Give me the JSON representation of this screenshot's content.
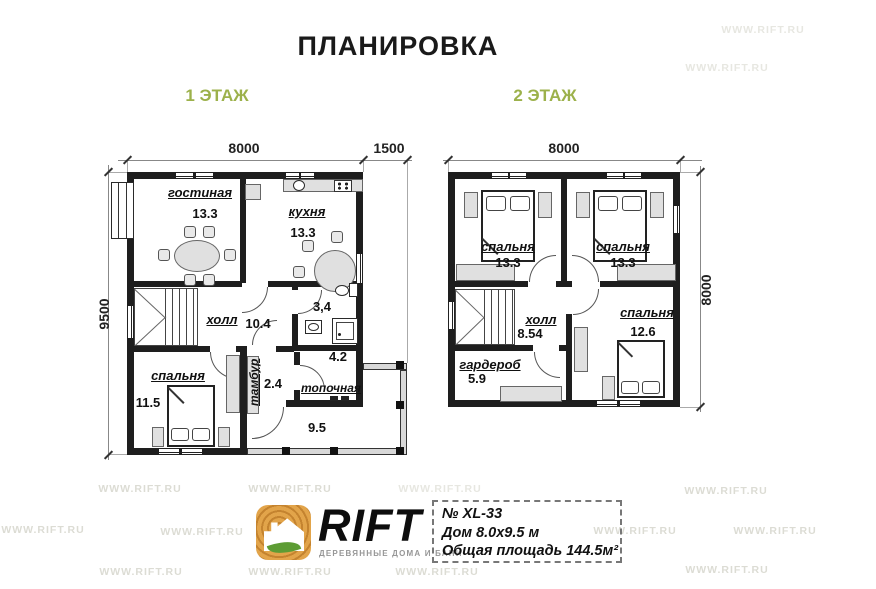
{
  "title": "ПЛАНИРОВКА",
  "watermark": "WWW.RIFT.RU",
  "floor1": {
    "label": "1 ЭТАЖ",
    "dim_width": "8000",
    "dim_porch": "1500",
    "dim_height": "9500",
    "rooms": {
      "living": {
        "label": "гостиная",
        "area": "13.3"
      },
      "kitchen": {
        "label": "кухня",
        "area": "13.3"
      },
      "hall": {
        "label": "холл",
        "area": "10.4"
      },
      "bathroom": {
        "area": "3,4"
      },
      "bedroom": {
        "label": "спальня",
        "area": "11.5"
      },
      "vestibule": {
        "label": "тамбур",
        "area": "2.4"
      },
      "boiler": {
        "label": "топочная",
        "area": "4.2"
      },
      "terrace": {
        "area": "9.5"
      }
    }
  },
  "floor2": {
    "label": "2 ЭТАЖ",
    "dim_width": "8000",
    "dim_height": "8000",
    "rooms": {
      "bedroom1": {
        "label": "спальня",
        "area": "13.3"
      },
      "bedroom2": {
        "label": "спальня",
        "area": "13.3"
      },
      "hall": {
        "label": "холл",
        "area": "8.54"
      },
      "wardrobe": {
        "label": "гардероб",
        "area": "5.9"
      },
      "bedroom3": {
        "label": "спальня",
        "area": "12.6"
      }
    }
  },
  "footer": {
    "brand": "RIFT",
    "tagline": "ДЕРЕВЯННЫЕ ДОМА И БАНИ",
    "model": "№ XL-33",
    "house_size": "Дом 8.0x9.5 м",
    "total_area": "Общая площадь 144.5м²"
  },
  "colors": {
    "wall": "#1e1e1e",
    "floor_label_green": "#9cb14b",
    "logo_orange": "#d79a3c",
    "leaf_green": "#5d9c34",
    "watermark_gray": "#dcdcd4"
  }
}
